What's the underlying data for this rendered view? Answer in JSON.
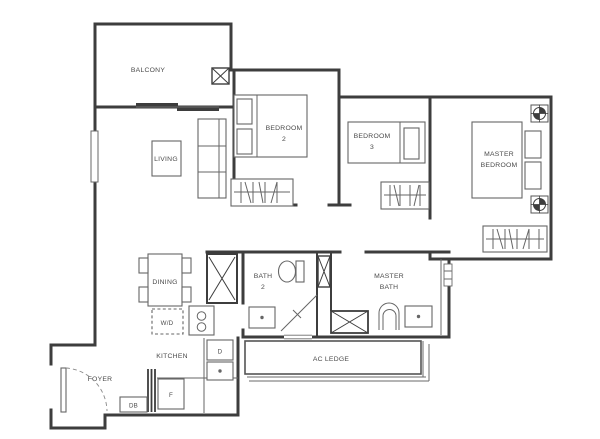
{
  "floor_plan": {
    "rooms": {
      "balcony": "BALCONY",
      "living": "LIVING",
      "dining": "DINING",
      "kitchen": "KITCHEN",
      "foyer": "FOYER",
      "ac_ledge": "AC LEDGE",
      "bedroom2_line1": "BEDROOM",
      "bedroom2_line2": "2",
      "bedroom3_line1": "BEDROOM",
      "bedroom3_line2": "3",
      "master_bedroom_line1": "MASTER",
      "master_bedroom_line2": "BEDROOM",
      "bath2_line1": "BATH",
      "bath2_line2": "2",
      "master_bath_line1": "MASTER",
      "master_bath_line2": "BATH"
    },
    "fixtures": {
      "washer_dryer": "W/D",
      "distribution_board": "DB",
      "fridge": "F",
      "dryer": "D"
    },
    "colors": {
      "wall": "#3d3d3d",
      "furniture_line": "#666666",
      "label_text": "#4a4a4a",
      "background": "#ffffff"
    }
  }
}
